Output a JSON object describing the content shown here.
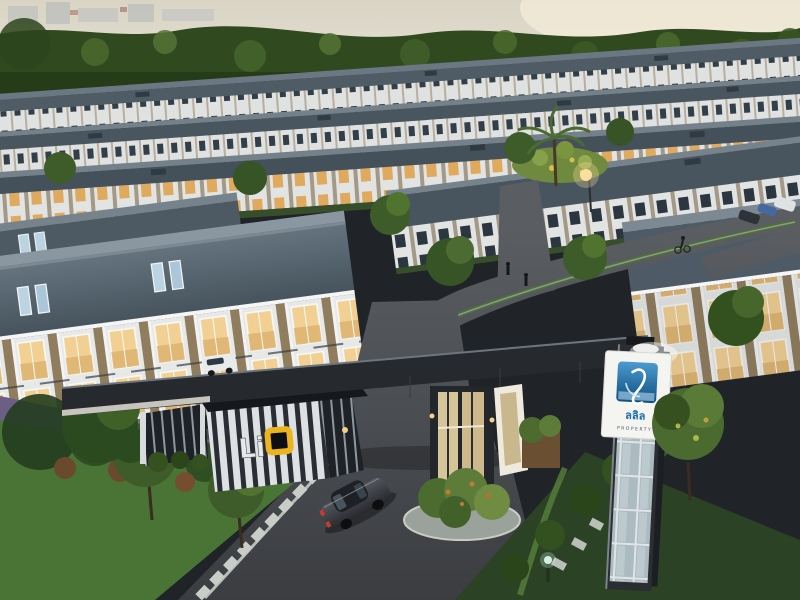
{
  "scene": {
    "description": "Aerial dusk 3D rendering of a gated townhouse village: rows of two-storey townhomes with slate roofs and lit windows, an entrance gateway with a dark canopy beam, a Lio guardhouse, a brand pylon sign, a curved asphalt road with a sedan, landscaping and trees"
  },
  "signage": {
    "guardhouse_brand": "Lio",
    "guardhouse_brand_prefix": "Li",
    "pylon_logo_text": "ลลิล",
    "pylon_logo_subtext": "PROPERTY"
  },
  "palette": {
    "sky": "#e7e4d8",
    "treeline": "#2f471e",
    "roof": "#4c5a65",
    "facade": "#e9ebea",
    "window_lit": "#f0cf92",
    "accent_panel": "#8f7c5c",
    "road": "#46494d",
    "lawn": "#4a7436",
    "lawn_dark": "#2c4224",
    "gate_structure": "#26292d",
    "logo_blue": "#2277b3",
    "logo_text_blue": "#1b6fae",
    "lio_yellow": "#ecb51e",
    "taillight_red": "#c43a2e"
  }
}
